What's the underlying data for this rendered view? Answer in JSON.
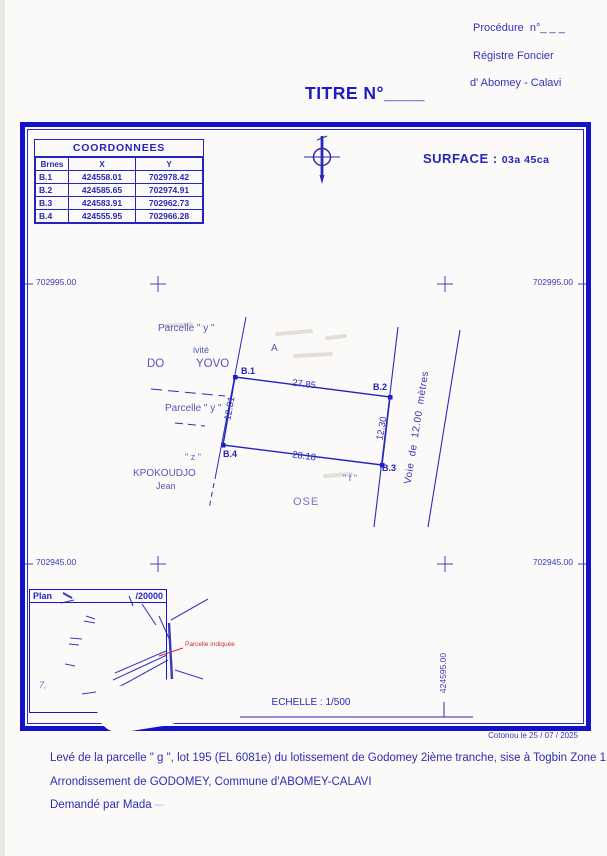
{
  "header": {
    "procedure": "Procédure  n°_ _ _",
    "registry_line1": "Régistre Foncier",
    "registry_line2": "d' Abomey - Calavi",
    "title": "TITRE N°____"
  },
  "surface": {
    "label": "SURFACE :",
    "value": "03a 45ca"
  },
  "coordinates_table": {
    "title": "COORDONNEES",
    "columns": [
      "Brnes",
      "X",
      "Y"
    ],
    "rows": [
      [
        "B.1",
        "424558.01",
        "702978.42"
      ],
      [
        "B.2",
        "424585.65",
        "702974.91"
      ],
      [
        "B.3",
        "424583.91",
        "702962.73"
      ],
      [
        "B.4",
        "424555.95",
        "702966.28"
      ]
    ]
  },
  "grid": {
    "y_top_left": "702995.00",
    "y_top_right": "702995.00",
    "y_bottom_left": "702945.00",
    "y_bottom_right": "702945.00",
    "x_gridline": "424595.00"
  },
  "plan": {
    "points": {
      "b1": "B.1",
      "b2": "B.2",
      "b3": "B.3",
      "b4": "B.4"
    },
    "dimensions": {
      "top": "27.85",
      "bottom": "28.18",
      "left": "12.31",
      "right": "12.30"
    },
    "road_label": "Voie  de  12.00  mètres",
    "neighbor_labels": {
      "parcelle_y_top": "Parcelle \" y \"",
      "activite_fragment": "ivité",
      "do_yovo": "DO          YOVO",
      "parcelle_y_mid": "Parcelle \" y \"",
      "z_fragment": "\" z \"",
      "kpokoudjo": "KPOKOUDJO",
      "jean": "Jean",
      "a_fragment": "A",
      "parcelle_f_fragment": "\" f \"",
      "ose_fragment": "OSE"
    }
  },
  "inset_map": {
    "title_left": "Plan",
    "title_right": "/20000",
    "annotation": "Parcelle indiquée",
    "fragment": "7,"
  },
  "scale_label": "ECHELLE : 1/500",
  "footer": {
    "date": "Cotonou le 25 / 07 / 2025",
    "line1": "Levé de la parcelle \" g \", lot 195 (EL 6081e) du lotissement de Godomey 2ième tranche, sise à Togbin Zone 1",
    "line2": "Arrondissement de GODOMEY, Commune d'ABOMEY-CALAVI",
    "line3": "Demandé par Mada",
    "line3_erased_fragment": "–·"
  },
  "colors": {
    "ink_blue": "#2e2eb5",
    "frame_blue": "#1212c8",
    "annotation_red": "#c23232"
  }
}
